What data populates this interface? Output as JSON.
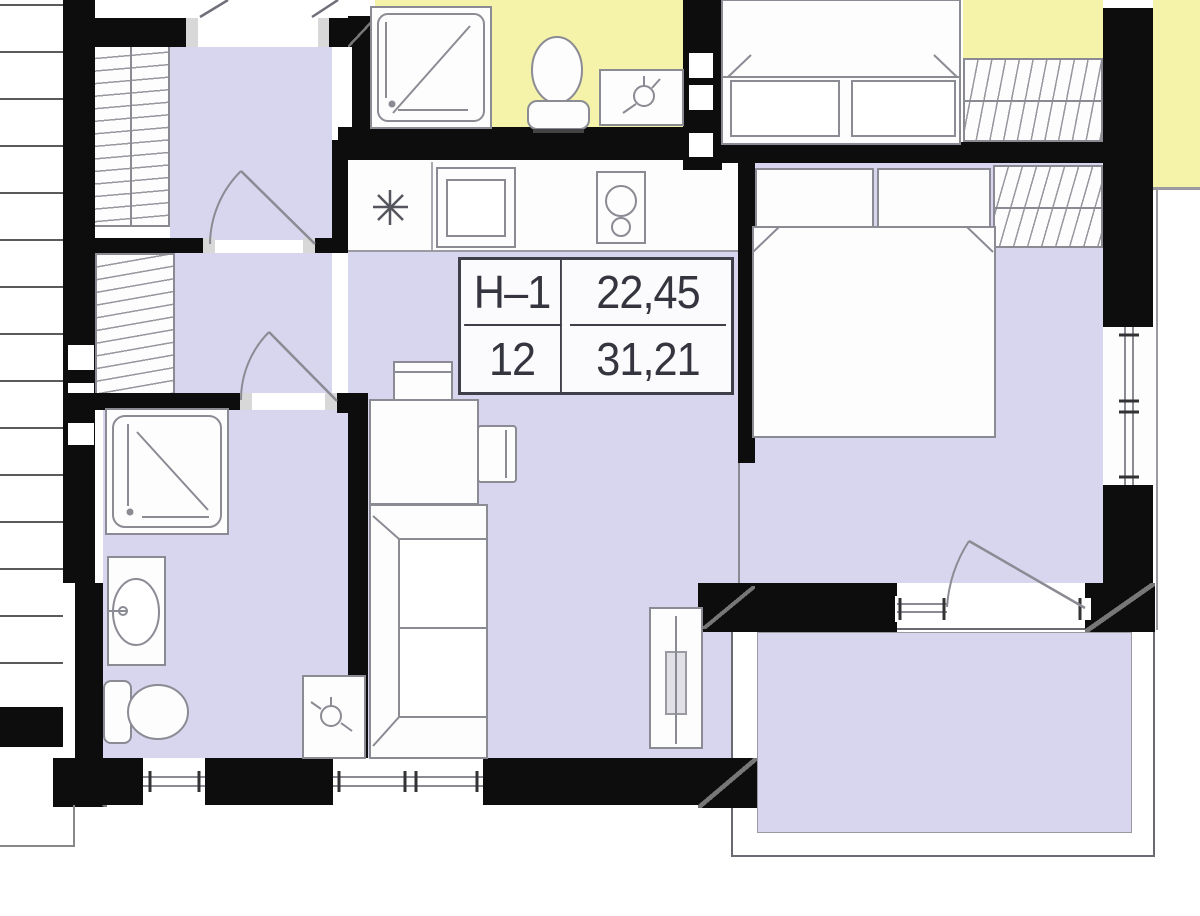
{
  "plan_label": {
    "unit": "Н–1",
    "area_unit": "22,45",
    "number": "12",
    "area_total": "31,21"
  },
  "colors": {
    "room_fill": "#d8d6ef",
    "neighbor_fill": "#f4f3a9",
    "wall": "#0d0d0d",
    "line": "#8b8b94",
    "label_text": "#35353f",
    "label_border": "#3f3f4a"
  }
}
